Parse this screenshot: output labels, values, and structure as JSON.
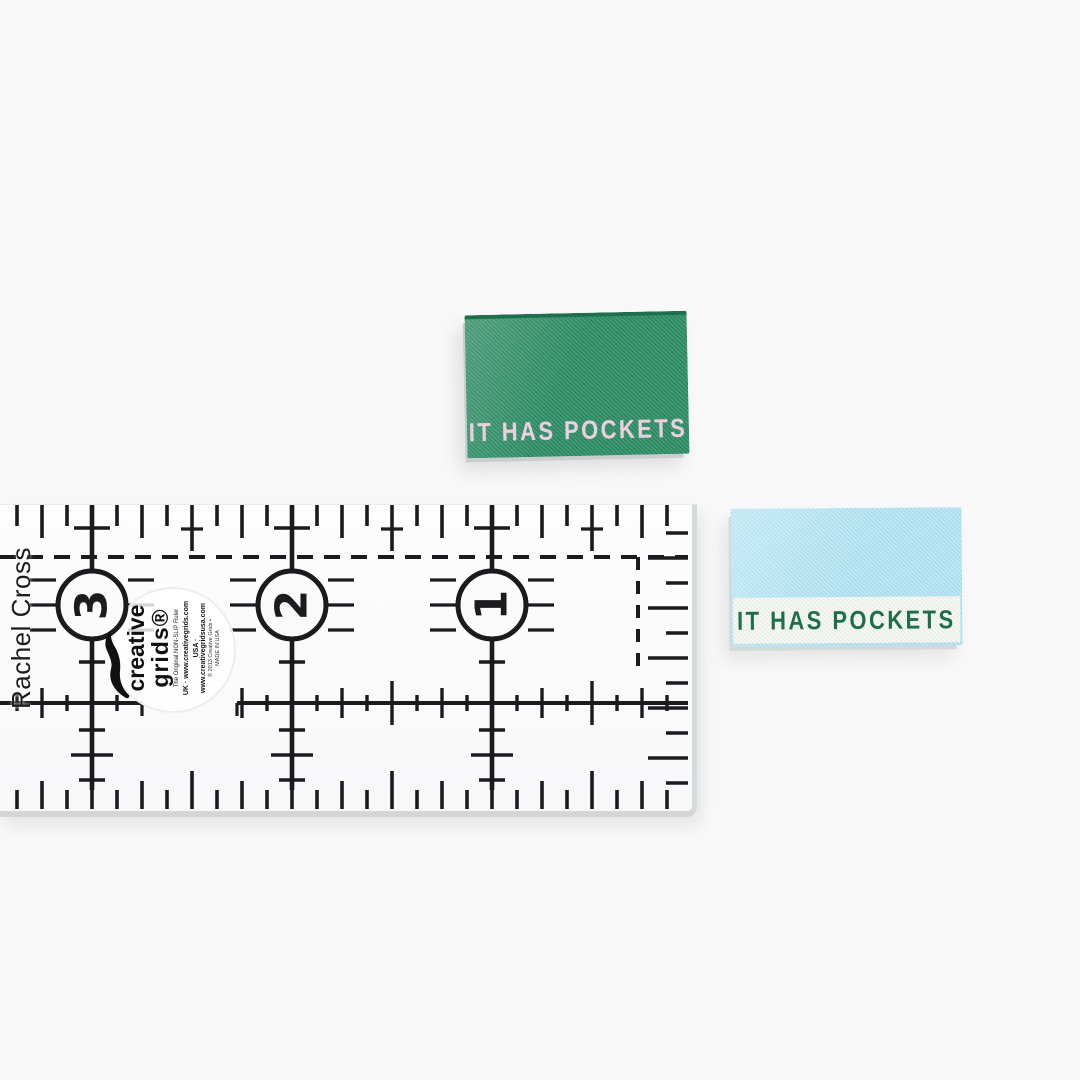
{
  "scene": {
    "background_color": "#f8f8f8"
  },
  "labels": {
    "green": {
      "text": "IT HAS POCKETS",
      "bg_color": "#2e8f67",
      "text_color": "#eccede"
    },
    "blue": {
      "text": "IT HAS POCKETS",
      "bg_color": "#b2e4f4",
      "band_color": "#f3f5ef",
      "text_color": "#1e6f48"
    }
  },
  "watermark": {
    "text": "Rachel Cross"
  },
  "ruler": {
    "numbers": [
      "3",
      "2",
      "1"
    ],
    "brand": {
      "name_line1": "creative",
      "name_line2": "grids®",
      "tagline": "The Original NON-SLIP Ruler",
      "uk_line": "UK · www.creativegrids.com",
      "usa_line": "USA · www.creativegridsusa.com",
      "copyright": "© 2013 Creative Grids •",
      "made_in": "MADE IN USA"
    }
  }
}
